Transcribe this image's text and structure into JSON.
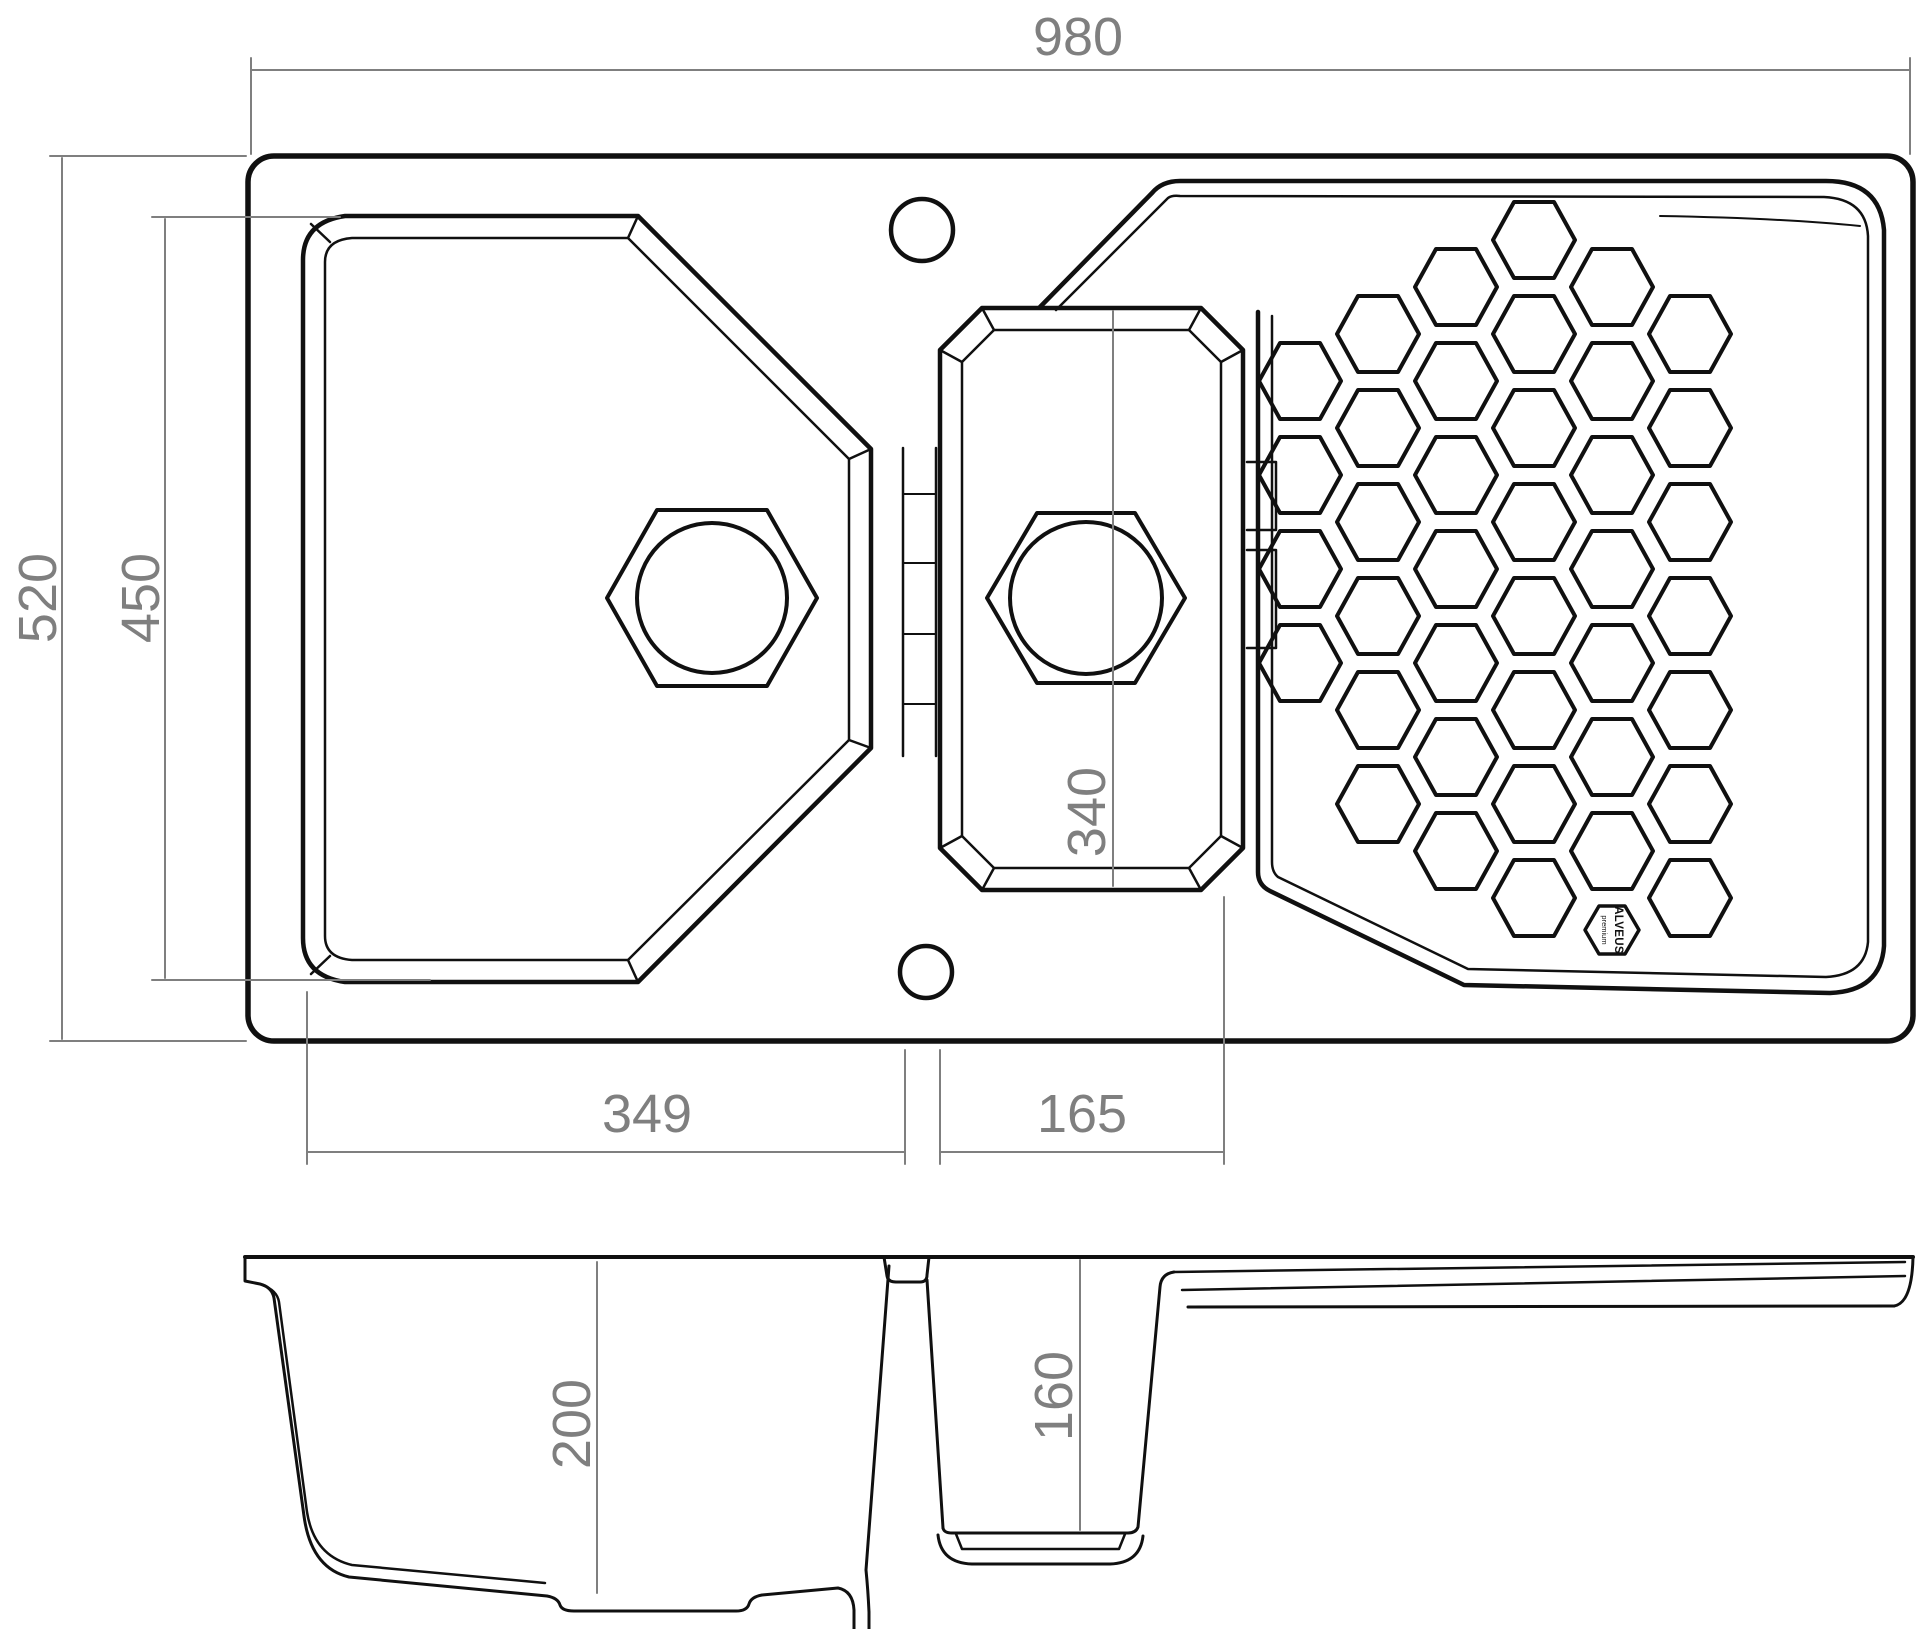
{
  "drawing": {
    "kind": "sink-technical-drawing",
    "views": [
      "top-view",
      "section-view"
    ]
  },
  "style": {
    "background": "#ffffff",
    "line_color": "#101010",
    "dim_color": "#7f7f7f",
    "dim_font_size": 54,
    "arrow_length": 32,
    "arrow_half_width": 7
  },
  "dimensions": [
    {
      "id": "overall-width",
      "label": "980",
      "line": [
        251,
        70,
        1910,
        70
      ],
      "text": {
        "x": 1078,
        "y": 55,
        "rotate": false
      },
      "arrows": [
        {
          "x": 251,
          "y": 70,
          "dir": "left"
        },
        {
          "x": 1910,
          "y": 70,
          "dir": "right"
        }
      ],
      "ext": [
        [
          251,
          58,
          251,
          154
        ],
        [
          1910,
          58,
          1910,
          154
        ]
      ]
    },
    {
      "id": "overall-depth",
      "label": "520",
      "line": [
        62,
        158,
        62,
        1039
      ],
      "text": {
        "x": 56,
        "y": 598,
        "rotate": true
      },
      "arrows": [
        {
          "x": 62,
          "y": 158,
          "dir": "up"
        },
        {
          "x": 62,
          "y": 1039,
          "dir": "down"
        }
      ],
      "ext": [
        [
          50,
          156,
          246,
          156
        ],
        [
          50,
          1041,
          246,
          1041
        ]
      ]
    },
    {
      "id": "bowl-zone-depth",
      "label": "450",
      "line": [
        165,
        219,
        165,
        978
      ],
      "text": {
        "x": 159,
        "y": 598,
        "rotate": true
      },
      "arrows": [
        {
          "x": 165,
          "y": 219,
          "dir": "up"
        },
        {
          "x": 165,
          "y": 978,
          "dir": "down"
        }
      ],
      "ext": [
        [
          152,
          217,
          340,
          217
        ],
        [
          152,
          980,
          430,
          980
        ]
      ]
    },
    {
      "id": "main-bowl-width",
      "label": "349",
      "line": [
        307,
        1152,
        905,
        1152
      ],
      "text": {
        "x": 647,
        "y": 1132,
        "rotate": false
      },
      "arrows": [
        {
          "x": 307,
          "y": 1152,
          "dir": "left"
        },
        {
          "x": 905,
          "y": 1152,
          "dir": "right"
        }
      ],
      "ext": [
        [
          307,
          992,
          307,
          1164
        ],
        [
          905,
          1050,
          905,
          1164
        ]
      ]
    },
    {
      "id": "half-bowl-width",
      "label": "165",
      "line": [
        940,
        1152,
        1224,
        1152
      ],
      "text": {
        "x": 1082,
        "y": 1132,
        "rotate": false
      },
      "arrows": [
        {
          "x": 940,
          "y": 1152,
          "dir": "left"
        },
        {
          "x": 1224,
          "y": 1152,
          "dir": "right"
        }
      ],
      "ext": [
        [
          940,
          1050,
          940,
          1164
        ],
        [
          1224,
          897,
          1224,
          1164
        ]
      ]
    },
    {
      "id": "half-bowl-length",
      "label": "340",
      "line": [
        1113,
        311,
        1113,
        886
      ],
      "text": {
        "x": 1105,
        "y": 812,
        "rotate": true
      },
      "arrows": [
        {
          "x": 1113,
          "y": 311,
          "dir": "up"
        },
        {
          "x": 1113,
          "y": 886,
          "dir": "down"
        }
      ],
      "ext": []
    },
    {
      "id": "main-bowl-depth",
      "label": "200",
      "line": [
        597,
        1262,
        597,
        1593
      ],
      "text": {
        "x": 590,
        "y": 1424,
        "rotate": true
      },
      "arrows": [
        {
          "x": 597,
          "y": 1262,
          "dir": "up"
        },
        {
          "x": 597,
          "y": 1593,
          "dir": "down"
        }
      ],
      "ext": []
    },
    {
      "id": "half-bowl-depth",
      "label": "160",
      "line": [
        1080,
        1260,
        1080,
        1530
      ],
      "text": {
        "x": 1072,
        "y": 1396,
        "rotate": true
      },
      "arrows": [
        {
          "x": 1080,
          "y": 1260,
          "dir": "up"
        },
        {
          "x": 1080,
          "y": 1530,
          "dir": "down"
        }
      ],
      "ext": []
    }
  ],
  "drain_holes": [
    {
      "id": "main-bowl-drain",
      "cx": 712,
      "cy": 598,
      "hex_rx": 105,
      "hex_ry": 88,
      "hex_top": 55,
      "circle_r": 75
    },
    {
      "id": "half-bowl-drain",
      "cx": 1086,
      "cy": 598,
      "hex_rx": 99,
      "hex_ry": 85,
      "hex_top": 49,
      "circle_r": 76
    }
  ],
  "holes": [
    {
      "id": "faucet-hole",
      "cx": 922,
      "cy": 230,
      "r": 31
    },
    {
      "id": "overflow-hole",
      "cx": 926,
      "cy": 972,
      "r": 26
    }
  ],
  "honeycomb": {
    "hex_rx": 41,
    "hex_ry": 38,
    "hex_top": 20,
    "columns": [
      {
        "x": 1300,
        "ys": [
          381,
          475,
          569,
          663
        ]
      },
      {
        "x": 1378,
        "ys": [
          334,
          428,
          522,
          616,
          710,
          804
        ]
      },
      {
        "x": 1456,
        "ys": [
          287,
          381,
          475,
          569,
          663,
          757,
          851
        ]
      },
      {
        "x": 1534,
        "ys": [
          240,
          334,
          428,
          522,
          616,
          710,
          804,
          898
        ]
      },
      {
        "x": 1612,
        "ys": [
          287,
          381,
          475,
          569,
          663,
          757,
          851
        ]
      },
      {
        "x": 1690,
        "ys": [
          334,
          428,
          522,
          616,
          710,
          804,
          898
        ]
      }
    ]
  },
  "logo": {
    "cx": 1612,
    "cy": 930,
    "hex_rx": 27,
    "hex_ry": 24,
    "hex_top": 13,
    "brand": "ALVEUS",
    "tagline": "premium"
  }
}
